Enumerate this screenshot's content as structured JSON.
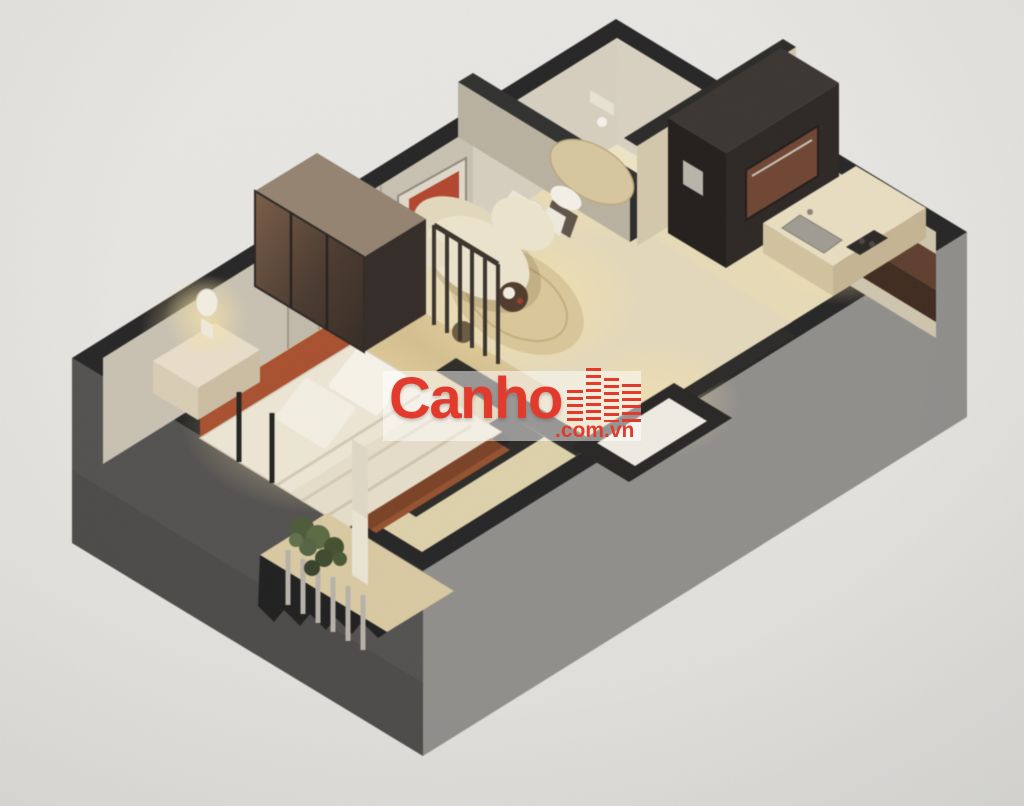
{
  "scene": {
    "description": "Photograph of a 3D isometric cutaway floor plan render of a studio apartment",
    "background_color": "#e6e5e2"
  },
  "watermark": {
    "brand": "Canho",
    "suffix": ".com.vn",
    "brand_color": "#e23b2e",
    "icon": "city-skyline-icon"
  },
  "palette": {
    "wall_top": "#262525",
    "facade_left": "#535150",
    "facade_right": "#908e8b",
    "floor_main": "#ddd1ab",
    "floor_bedroom": "#d5bf90",
    "floor_bathroom": "#e9e3d3",
    "floor_kitchen": "#e6dab6",
    "wall_face": "#c8c1b2",
    "accent_terracotta": "#a8502f",
    "cabinet_wood": "#5e3e2e",
    "bedding": "#ece5d4",
    "sofa": "#ece3cc",
    "rug": "#d8c598",
    "plant_green": "#4d5a38"
  },
  "rooms": [
    {
      "name": "bedroom"
    },
    {
      "name": "living-area"
    },
    {
      "name": "bathroom"
    },
    {
      "name": "kitchen"
    },
    {
      "name": "balcony"
    },
    {
      "name": "entrance"
    }
  ]
}
